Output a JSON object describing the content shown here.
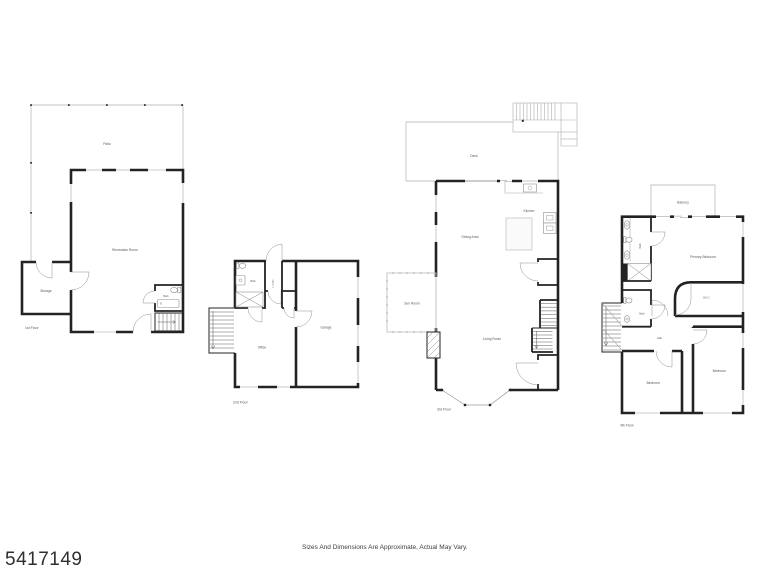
{
  "footer": {
    "listing_number": "5417149",
    "disclaimer": "Sizes And Dimensions Are Approximate, Actual May Vary."
  },
  "floor1": {
    "label": "1st Floor",
    "patio": "Patio",
    "recreation_room": "Recreation Room",
    "storage": "Storage",
    "bath": "Bath"
  },
  "floor2": {
    "label": "2nd Floor",
    "bath": "Bath",
    "laundry": "Laundry",
    "office": "Office",
    "garage": "Garage"
  },
  "floor3": {
    "label": "3rd Floor",
    "deck": "Deck",
    "kitchen": "Kitchen",
    "dining_area": "Dining Area",
    "sun_room": "Sun Room",
    "living_room": "Living Room"
  },
  "floor4": {
    "label": "4th Floor",
    "balcony": "Balcony",
    "bath_upper": "Bath",
    "primary_bedroom": "Primary Bedroom",
    "wic": "W.I.C.",
    "bath_lower": "Bath",
    "hall": "Hall",
    "bedroom_left": "Bedroom",
    "bedroom_right": "Bedroom"
  },
  "colors": {
    "background": "#ffffff",
    "wall": "#232323",
    "light_line": "#c2c2c2",
    "label_text": "#585858"
  }
}
